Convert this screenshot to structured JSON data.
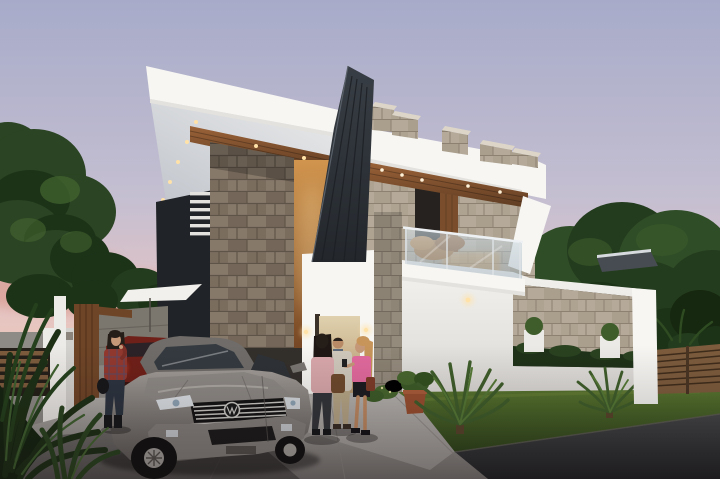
{
  "meta": {
    "title": "Modern villa exterior 3D rendering at dusk",
    "type": "architectural-visualization",
    "time_of_day": "dusk",
    "canvas": "720x479"
  },
  "scene": {
    "description": "Photorealistic dusk rendering of a modern two-storey white villa with cantilevered flat roofs, a charcoal vertical fin, rough stone columns, wood plank soffits with recessed downlights, stone parapet blocks, and a glass-railed balcony. A gray Volkswagen sedan and a partially hidden red car sit in the driveway. A woman in a plaid shirt talks on a phone by the gate while three visitors chat near the cream entrance door. Landscaped lawn with cycad palms, a terracotta pot, wooden fences, overhanging tree canopy and pink sunset clouds complete the scene.",
    "objects": [
      {
        "name": "sky",
        "desc": "dusk gradient, lavender to pink horizon"
      },
      {
        "name": "sunset-clouds",
        "desc": "soft pink cloud bands near horizon"
      },
      {
        "name": "pine-tree",
        "desc": "dark conifer on the left"
      },
      {
        "name": "tree-canopy",
        "desc": "leafy branches overhanging from top right"
      },
      {
        "name": "background-trees",
        "desc": "dark trees and neighbour roof behind villa"
      },
      {
        "name": "villa",
        "desc": "white geometric house, stone, wood soffits, downlights"
      },
      {
        "name": "charcoal-fin",
        "desc": "dark ribbed vertical blade at the centre"
      },
      {
        "name": "balcony",
        "desc": "glass railing with steel handrail, dry plant"
      },
      {
        "name": "parapet-blocks",
        "desc": "five stone cubes on the roof band"
      },
      {
        "name": "compound-wall",
        "desc": "white wall with stone-clad opening, planters, hedge"
      },
      {
        "name": "entrance-door",
        "desc": "cream door behind the visitor group"
      },
      {
        "name": "wall-sconces",
        "desc": "warm lit fixtures on entrance walls"
      },
      {
        "name": "gate",
        "desc": "wooden gate, white chimney pillar, floating canopy"
      },
      {
        "name": "volkswagen-sedan",
        "desc": "warm gray VW sedan, chrome grille, VW badge"
      },
      {
        "name": "red-car",
        "desc": "red car glimpsed behind the sedan, bright taillight"
      },
      {
        "name": "woman-on-phone",
        "desc": "dark-haired woman, red plaid shirt, dark jeans"
      },
      {
        "name": "visitor-group",
        "desc": "two women and a man talking near the door"
      },
      {
        "name": "garden",
        "desc": "lawn, cycad palms, terracotta pot, wooden fence"
      },
      {
        "name": "driveway-and-road",
        "desc": "light concrete driveway, dark asphalt street"
      }
    ],
    "car_badge": "VW"
  },
  "colors": {
    "sky_top": "#a7abc9",
    "sky_mid": "#c5bfd1",
    "sky_pink": "#e3c3c4",
    "sky_horizon": "#efcab7",
    "cloud": "#d89a8c",
    "tree_dark": "#1d3318",
    "tree_mid": "#2b4423",
    "tree_light": "#456631",
    "canopy_dark": "#243c1e",
    "canopy_mid": "#2f4d27",
    "canopy_light": "#3c5c2c",
    "branch": "#3a3226",
    "white_lit": "#f7f6f3",
    "white_soft": "#e4e2de",
    "soffit_light": "#eceded",
    "soffit_dark": "#bfc3ca",
    "wood_light": "#9a6238",
    "wood_dark": "#5f3c22",
    "fin_top": "#383e45",
    "fin_bottom": "#23272c",
    "stone_base": "#87796a",
    "stone_dark": "#6d5f51",
    "stone_grout": "#5f5448",
    "stonel_base": "#b5aa99",
    "stonel_dark": "#a89c89",
    "stonel_grout": "#8d8272",
    "warm_top": "#d1954e",
    "warm_bottom": "#754624",
    "glow": "#ffe2a8",
    "door_top": "#e0d1ae",
    "door_bottom": "#b3946c",
    "glass_light": "#d7e4eb",
    "glass_dark": "#96aab9",
    "rail": "#eef1f3",
    "wall_top": "#f4f3f0",
    "wall_bottom": "#dbd9d5",
    "lawn_light": "#5a7830",
    "lawn_dark": "#2f471c",
    "hedge": "#1f3319",
    "road_top": "#45474a",
    "road_bottom": "#222426",
    "drive_light": "#b3b0ac",
    "drive_dark": "#7b7875",
    "fence_wood": "#7d5c3d",
    "fence_line": "#3f2c1b",
    "gate_wood": "#6f4527",
    "car_top": "#a09b96",
    "car_bottom": "#615e5b",
    "car_roof": "#6f6c69",
    "car_glass": "#343a40",
    "chrome": "#cccbc7",
    "tire": "#121212",
    "alloy": "#a6a39e",
    "red_car": "#6f2018",
    "taillight": "#e2442c",
    "skin": "#c59878",
    "hair_dark": "#241d18",
    "hair_blonde": "#c7955a",
    "plaid": "#93392f",
    "denim": "#2c3440",
    "pink_soft": "#d9a8ac",
    "pink_bright": "#e26a9e",
    "khaki": "#b8a888",
    "jacket": "#cfc8bb",
    "skirt": "#1c1c20",
    "bag_brown": "#6e4a2e",
    "pot": "#9a4f30",
    "pot_rim": "#ab5d3a",
    "ground_base": "#8e8b87"
  }
}
